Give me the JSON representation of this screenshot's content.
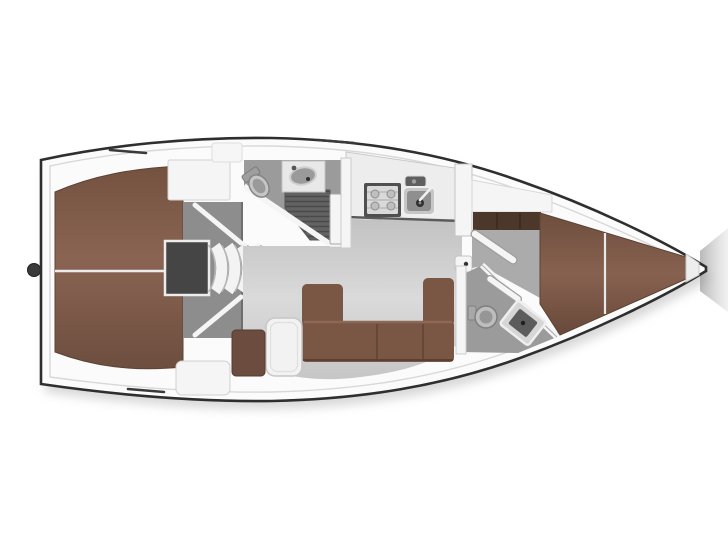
{
  "legend": {
    "type": "sailing-yacht-interior-floor-plan",
    "view": "top-down",
    "orientation": "bow-right",
    "rooms": [
      {
        "name": "aft-cabin",
        "features": [
          "full-beam-double-berth"
        ]
      },
      {
        "name": "companionway",
        "features": [
          "curved-steps",
          "engine-hatch"
        ]
      },
      {
        "name": "aft-head",
        "features": [
          "toilet",
          "washbasin",
          "shower-grate",
          "door"
        ]
      },
      {
        "name": "galley",
        "features": [
          "stove",
          "sink",
          "counter"
        ]
      },
      {
        "name": "salon",
        "features": [
          "u-shaped-settee",
          "table",
          "stool-seat"
        ]
      },
      {
        "name": "forward-head",
        "features": [
          "toilet",
          "washbasin",
          "door"
        ]
      },
      {
        "name": "forward-cabin",
        "features": [
          "v-berth",
          "wardrobe",
          "door"
        ]
      }
    ]
  },
  "colors": {
    "background": "#ffffff",
    "hull_line": "#2e2e2e",
    "deck": "#fbfbfb",
    "inner_trim": "#d8d8d8",
    "berth": "#7d5b4a",
    "berth_edge": "#5c4336",
    "settee": "#7a5644",
    "settee_edge": "#5e4234",
    "stool": "#6b4c3e",
    "wardrobe": "#4c372b",
    "table": "#f2f2f2",
    "salon_floor": "#cdcdcd",
    "cabin_floor": "#ababab",
    "head_floor": "#9b9b9b",
    "shower_floor": "#626262",
    "engine_panel": "#8d8d8d",
    "engine_hatch": "#454545",
    "steps": "#f3f3f3",
    "wall": "#f5f5f5",
    "wall_edge": "#bcbcbc",
    "counter": "#ededed",
    "fixture_light": "#c6c6c6",
    "fixture_mid": "#9a9a9a",
    "sink_basin": "#8f8f8f",
    "sink_dark": "#5c5c5c",
    "metal_dark": "#3a3a3a",
    "shadow": "#a8a8a8"
  }
}
